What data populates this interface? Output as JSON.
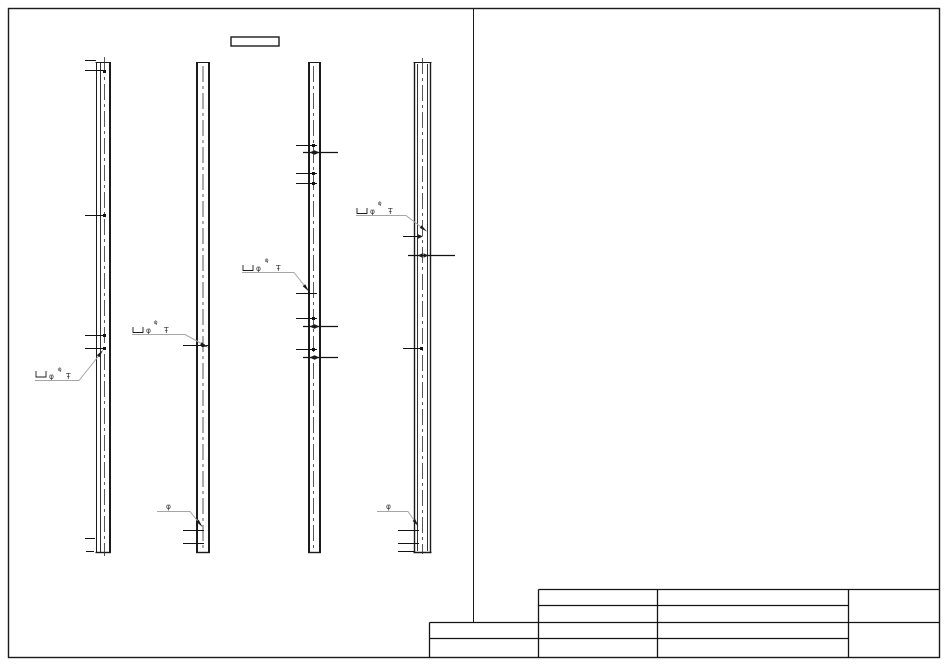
{
  "page": {
    "background": "#ffffff",
    "line_color": "#1b1b1b",
    "leader_color": "#a6a6a6"
  },
  "drawing": {
    "type": "structural-pile-elevation",
    "pile_count": 4,
    "label_box_text": "",
    "full_callout": {
      "bracket_icon": "⊔",
      "diameter_symbol": "φ",
      "diameter_superscript": "φ",
      "level_mark": "Ŧ"
    },
    "simple_callout": {
      "diameter_symbol": "φ"
    }
  },
  "title_block": {
    "rows": [
      [
        "",
        "",
        ""
      ],
      [
        "",
        "",
        ""
      ],
      [
        "",
        "",
        "",
        ""
      ],
      [
        "",
        "",
        "",
        ""
      ]
    ]
  }
}
